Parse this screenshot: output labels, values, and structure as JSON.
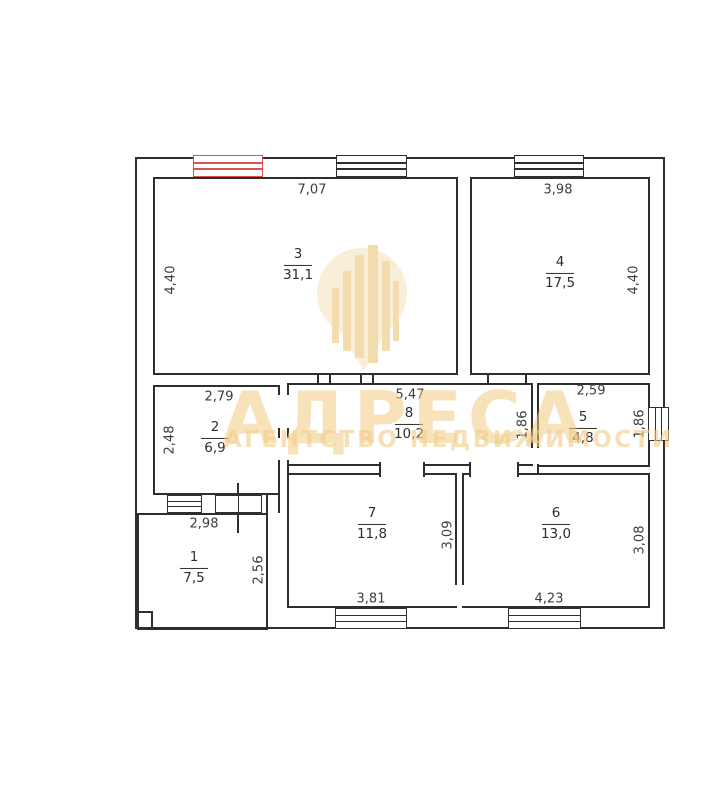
{
  "watermark": {
    "brand": "АДРЕСА",
    "tagline": "АГЕНТСТВО НЕДВИЖИМОСТИ",
    "color": "#f0cb80"
  },
  "colors": {
    "wall": "#2e2e2e",
    "highlight_window": "#d9534f"
  },
  "rooms": {
    "r1": {
      "number": "1",
      "area": "7,5"
    },
    "r2": {
      "number": "2",
      "area": "6,9"
    },
    "r3": {
      "number": "3",
      "area": "31,1"
    },
    "r4": {
      "number": "4",
      "area": "17,5"
    },
    "r5": {
      "number": "5",
      "area": "4,8"
    },
    "r6": {
      "number": "6",
      "area": "13,0"
    },
    "r7": {
      "number": "7",
      "area": "11,8"
    },
    "r8": {
      "number": "8",
      "area": "10,2"
    }
  },
  "dims": {
    "room3_width": "7,07",
    "room4_width": "3,98",
    "room3_height": "4,40",
    "room4_height": "4,40",
    "room2_width": "2,79",
    "room8_width": "5,47",
    "room5_width": "2,59",
    "room2_height": "2,48",
    "room8_height": "1,86",
    "room5_height": "1,86",
    "room1_width": "2,98",
    "room1_height": "2,56",
    "room7_height": "3,09",
    "room6_height": "3,08",
    "room7_window_width": "3,81",
    "room6_window_width": "4,23"
  }
}
